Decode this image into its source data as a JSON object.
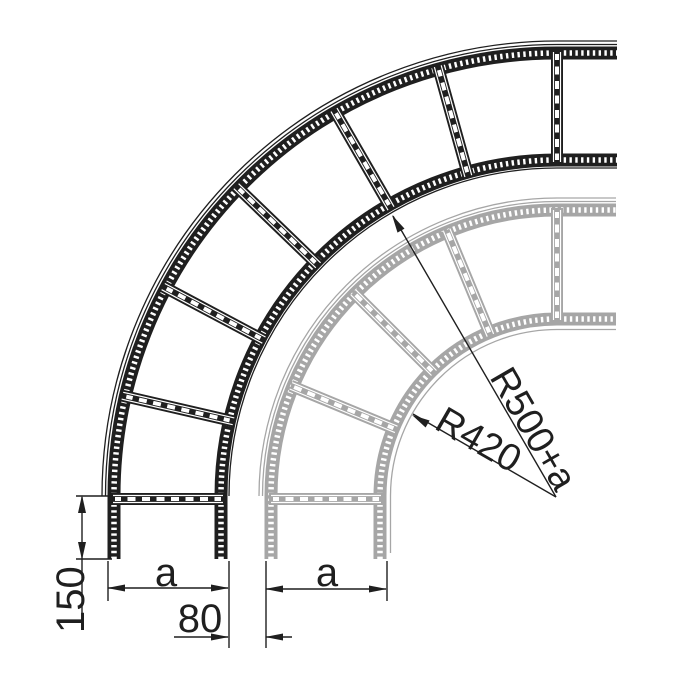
{
  "drawing": {
    "title": "90-degree cable ladder bend, plan view, two radius variants overlaid",
    "labels": {
      "radius_large": "R500+a",
      "radius_small": "R420",
      "tangent_leg": "150",
      "offset": "80",
      "width_large": "a",
      "width_small": "a"
    },
    "colors": {
      "ink": "#1f1f1f",
      "ghost_ladder": "#a6a6a6",
      "holes": "#ffffff",
      "background": "#ffffff"
    }
  }
}
